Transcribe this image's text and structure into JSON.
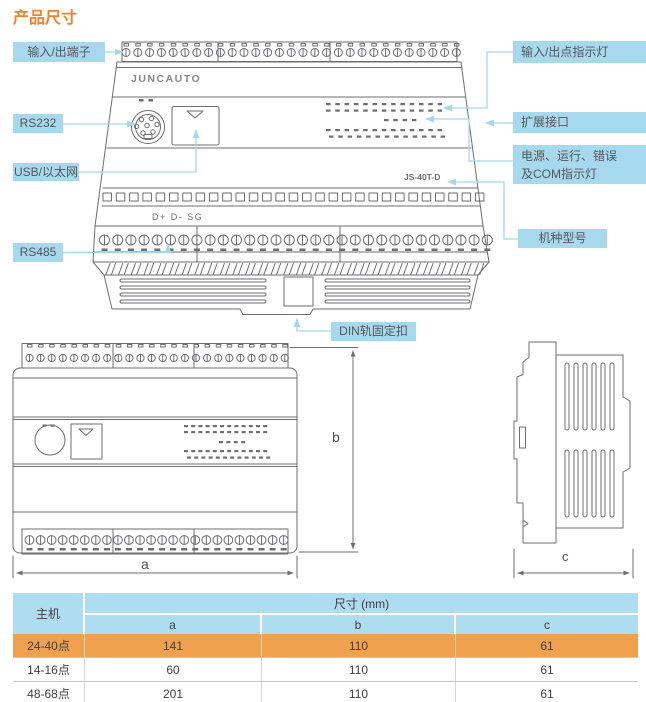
{
  "page": {
    "title": "产品尺寸"
  },
  "device": {
    "brand": "JUNCAUTO",
    "model": "JS-40T-D",
    "rs485_terminals": "D+ D- SG"
  },
  "callouts": {
    "io_terminals": "输入/出端子",
    "rs232": "RS232",
    "usb_ethernet": "USB/以太网",
    "rs485": "RS485",
    "io_indicators": "输入/出点指示灯",
    "expansion_port": "扩展接口",
    "power_indicators_line1": "电源、运行、错误",
    "power_indicators_line2": "及COM指示灯",
    "model_label": "机种型号",
    "din_clip": "DIN轨固定扣"
  },
  "dimensions": {
    "a": "a",
    "b": "b",
    "c": "c"
  },
  "table": {
    "header_main": "主机",
    "header_size": "尺寸 (mm)",
    "columns": [
      "a",
      "b",
      "c"
    ],
    "rows": [
      {
        "model": "24-40点",
        "a": "141",
        "b": "110",
        "c": "61",
        "highlighted": true
      },
      {
        "model": "14-16点",
        "a": "60",
        "b": "110",
        "c": "61",
        "highlighted": false
      },
      {
        "model": "48-68点",
        "a": "201",
        "b": "110",
        "c": "61",
        "highlighted": false
      }
    ]
  },
  "colors": {
    "title": "#ef8429",
    "callout_bg": "#a7d9ee",
    "leader_line": "#a3d7ec",
    "line_art": "#6d6e71",
    "table_header_bg": "#aedcf0",
    "highlight_row_bg": "#efa14e",
    "text": "#55565a"
  }
}
